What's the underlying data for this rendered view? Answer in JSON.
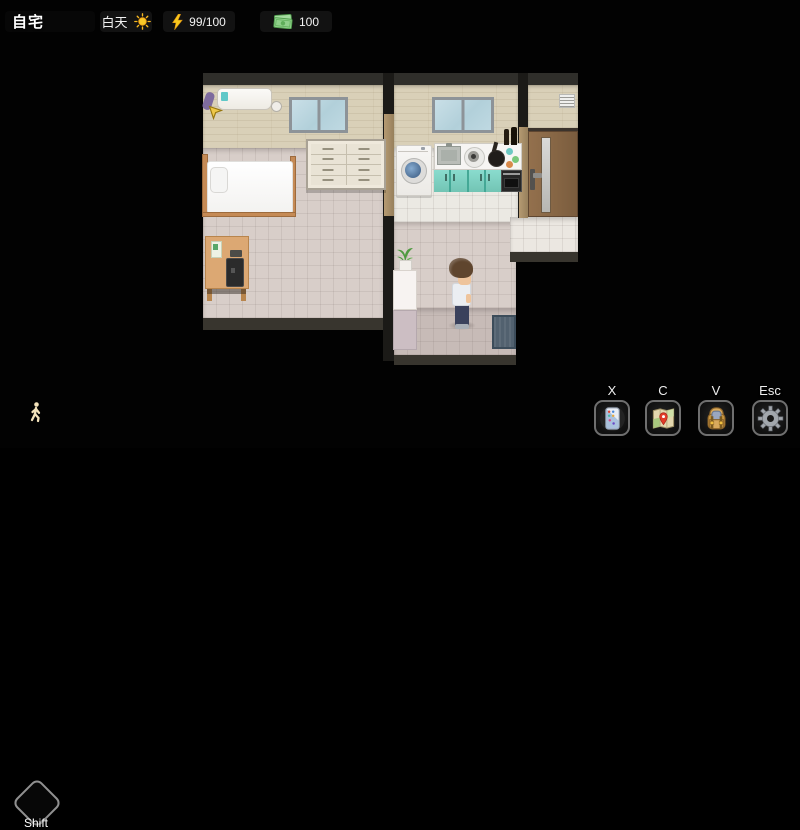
{
  "hud": {
    "location": "自宅",
    "time": {
      "label": "白天",
      "icon": "sun-icon"
    },
    "energy": {
      "icon": "lightning-icon",
      "value": "99/100"
    },
    "money": {
      "icon": "cash-icon",
      "value": "100"
    }
  },
  "controls": {
    "sprint": {
      "key_label": "Shift",
      "icon": "walking-person-icon"
    },
    "hotkeys": [
      {
        "key_label": "X",
        "icon": "phone-icon"
      },
      {
        "key_label": "C",
        "icon": "map-icon"
      },
      {
        "key_label": "V",
        "icon": "backpack-icon"
      },
      {
        "key_label": "Esc",
        "icon": "gear-icon"
      }
    ]
  },
  "scene": {
    "objects": [
      "air-conditioner",
      "bedroom-window",
      "bed",
      "dresser",
      "desk",
      "laptop",
      "kitchen-window",
      "washing-machine",
      "kitchen-counter",
      "sink",
      "stove",
      "wok",
      "oven",
      "teal-cabinets",
      "entrance-door",
      "wall-vent",
      "fridge",
      "potted-plant",
      "door-mat",
      "player-character",
      "quest-arrow"
    ]
  },
  "colors": {
    "wall_beige": "#d9d0b8",
    "floor_pink": "#d8cec9",
    "floor_white": "#ebe9e3",
    "cabinet_teal": "#7ed2c2",
    "door_brown": "#8b6a49",
    "energy_yellow": "#f8c81c",
    "money_green": "#8fd08a",
    "hud_chip_bg": "#171717"
  }
}
